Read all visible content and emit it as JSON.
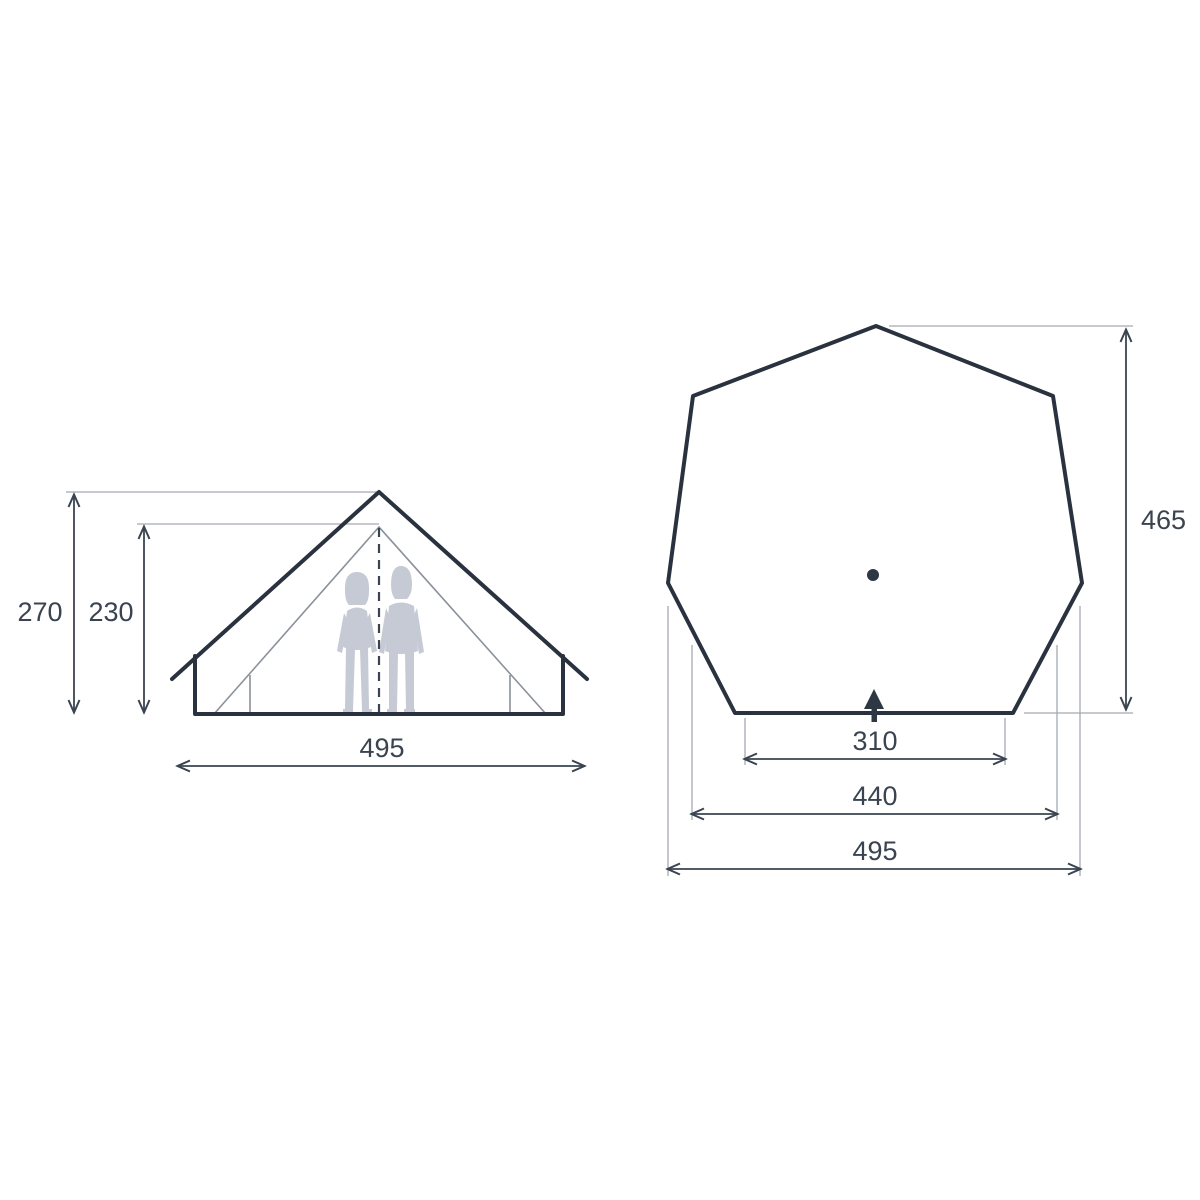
{
  "diagram_title": "tent-dimensions-diagram",
  "colors": {
    "background": "#ffffff",
    "outline": "#29323e",
    "dimension": "#3a4450",
    "extension_line": "#a3aab2",
    "silhouette": "#c6cad4"
  },
  "elevation_view": {
    "total_height": "270",
    "inner_height": "230",
    "width": "495"
  },
  "plan_view": {
    "depth": "465",
    "entrance_width": "310",
    "mid_width": "440",
    "total_width": "495"
  }
}
